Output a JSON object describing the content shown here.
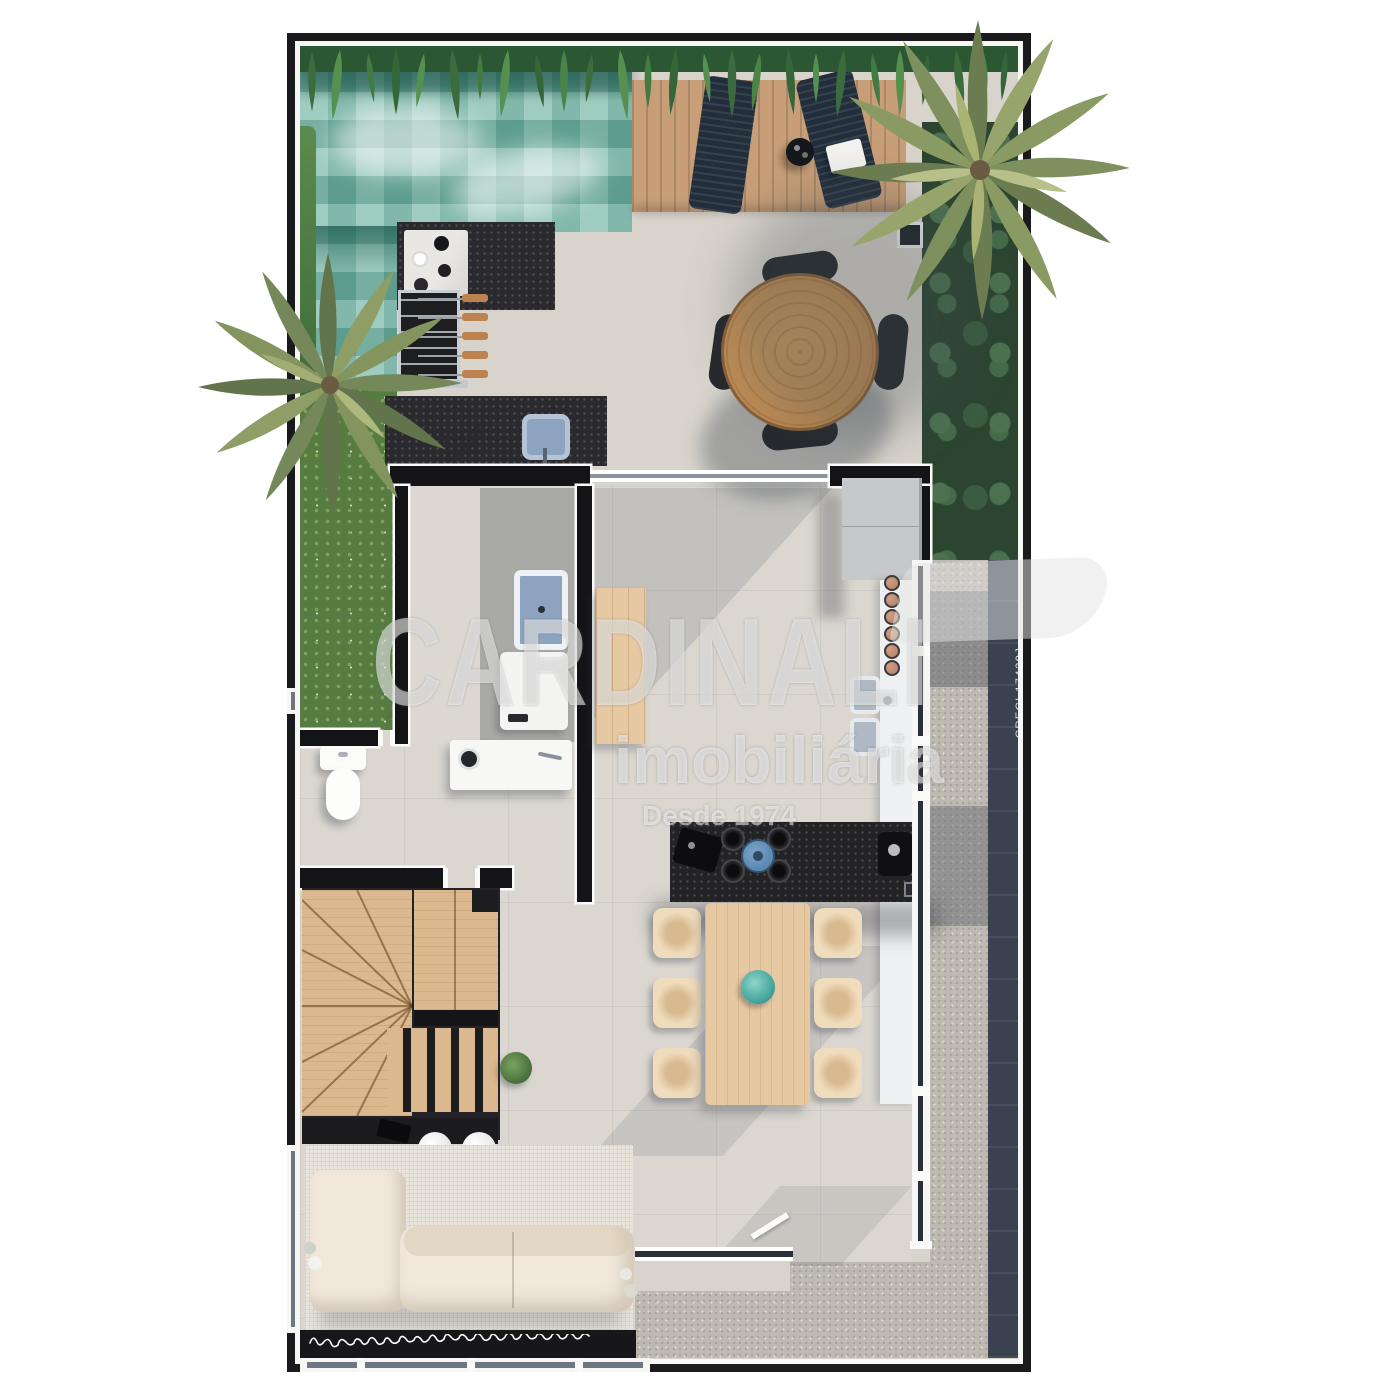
{
  "watermark": {
    "brand": "CARDINALI",
    "subtitle": "imobiliária",
    "tagline": "Desde 1974",
    "license": "CRECI 17429J"
  },
  "palette": {
    "frame": "#1a1a1c",
    "frameline": "#f6f6f4",
    "patio": "#d8d3cb",
    "floor": "#dbd7d0",
    "poolbase": "#7fbcac",
    "pooldark": "#2f6e63",
    "fern1": "#3c6b3d",
    "fern2": "#55904e",
    "monstera": "#2c4531",
    "deck": "#c79e77",
    "lounger": "#232e3c",
    "tablewood": "#b9854f",
    "chairdark": "#26292d",
    "counterdark": "#2a2a2e",
    "marble": "#e9e7e4",
    "sinkblue": "#8da4c0",
    "wall": "#141416",
    "wallwhite": "#fafaf8",
    "grass": "#567c41",
    "woodlight": "#e6c9a2",
    "chaircream": "#efdcbc",
    "stool": "#b47d64",
    "granite": "#232326",
    "kettle": "#5b87b0",
    "bowlteal": "#43a49b",
    "counterwhite": "#eef0f1",
    "fridge": "#c7c8c9",
    "gravel": "#beb9b1",
    "paver": "#3a4250",
    "rug": "#e9e5dd",
    "sofa": "#f1e8da",
    "stairwood": "#dcb88e",
    "stairdark": "#232327",
    "glass": "#6e7681",
    "wm": "rgba(255,255,255,0.52)"
  }
}
